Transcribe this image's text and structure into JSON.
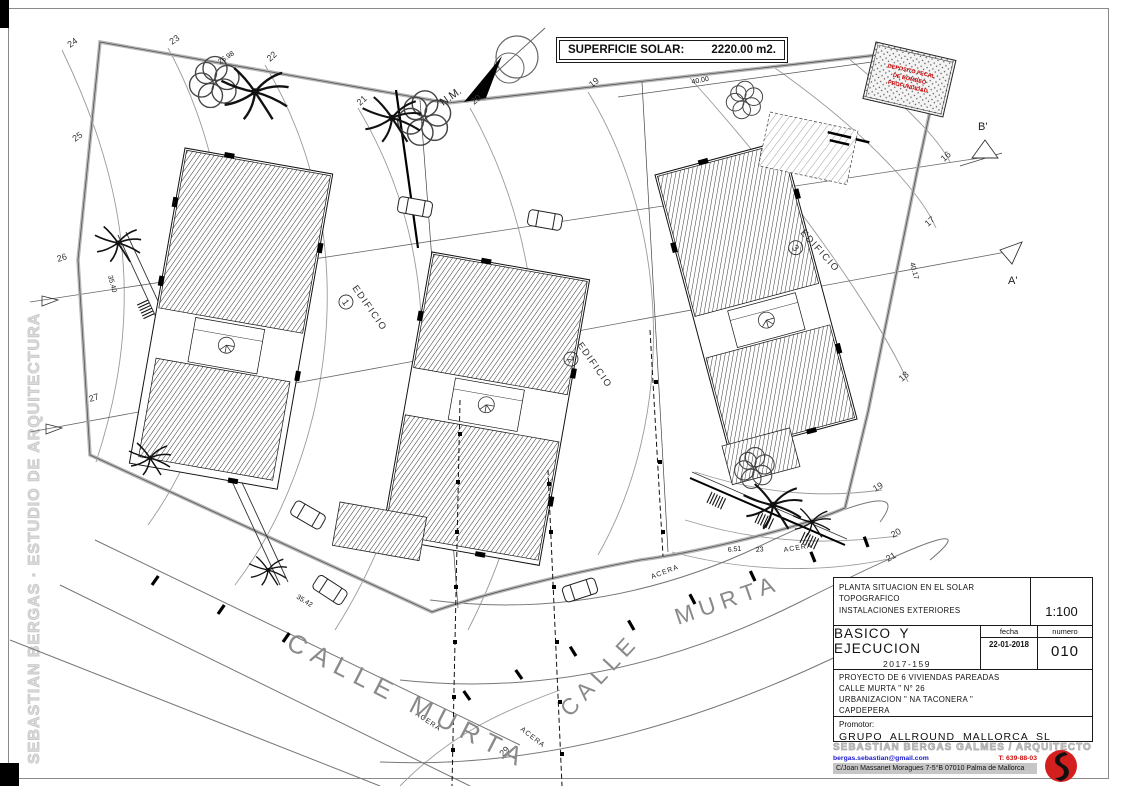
{
  "watermark": {
    "text": "SEBASTIAN BERGAS · ESTUDIO DE ARQUITECTURA"
  },
  "area_box": {
    "label": "SUPERFICIE SOLAR:",
    "value": "2220.00 m2."
  },
  "compass": {
    "label": "N.M."
  },
  "plan": {
    "buildings": [
      {
        "label": "EDIFICIO",
        "num": "1"
      },
      {
        "label": "EDIFICIO",
        "num": "2"
      },
      {
        "label": "EDIFICIO",
        "num": "3"
      }
    ],
    "section_markers": [
      {
        "label": "B'"
      },
      {
        "label": "A'"
      }
    ],
    "deposit_note": {
      "lines": [
        "DEPOSITO FECAL",
        "DE BOMBEO",
        "PROFUNDIDAD"
      ]
    },
    "streets": {
      "calle_murta": "CALLE MURTA",
      "calle": "CALLE",
      "murta": "MURTA",
      "acera": "ACERA"
    },
    "contour_labels": [
      "24",
      "23",
      "22",
      "21",
      "20",
      "19",
      "25",
      "26",
      "27",
      "16",
      "17",
      "18",
      "19",
      "20",
      "21",
      "29"
    ],
    "dimensions": [
      "26.98",
      "40.00",
      "35.40",
      "40.17",
      "35.42",
      "6.51",
      "23"
    ]
  },
  "title_block": {
    "description": {
      "line1": "PLANTA SITUACION EN EL SOLAR",
      "line2": "TOPOGRAFICO",
      "line3": "INSTALACIONES EXTERIORES"
    },
    "scale": "1:100",
    "phase": "BASICO Y EJECUCION",
    "project_code": "2017-159",
    "fecha_label": "fecha",
    "fecha": "22-01-2018",
    "numero_label": "numero",
    "numero": "010",
    "project": {
      "line1": "PROYECTO DE 6 VIVIENDAS PAREADAS",
      "line2": "CALLE MURTA \" N° 26",
      "line3": "URBANIZACION \" NA TACONERA \"",
      "line4": "CAPDEPERA"
    },
    "promotor_label": "Promotor:",
    "promotor": "GRUPO ALLROUND MALLORCA SL"
  },
  "footer": {
    "architect": "SEBASTIAN BERGAS GALMES / ARQUITECTO",
    "email": "bergas.sebastian@gmail.com",
    "phone": "T: 639-88-03",
    "address": "C/Joan Massanet Moragues 7-5°B   07010 Palma de Mallorca"
  },
  "colors": {
    "accent_red": "#cc1111",
    "link_blue": "#1a1acc",
    "watermark_gray": "#dcdcdc"
  }
}
